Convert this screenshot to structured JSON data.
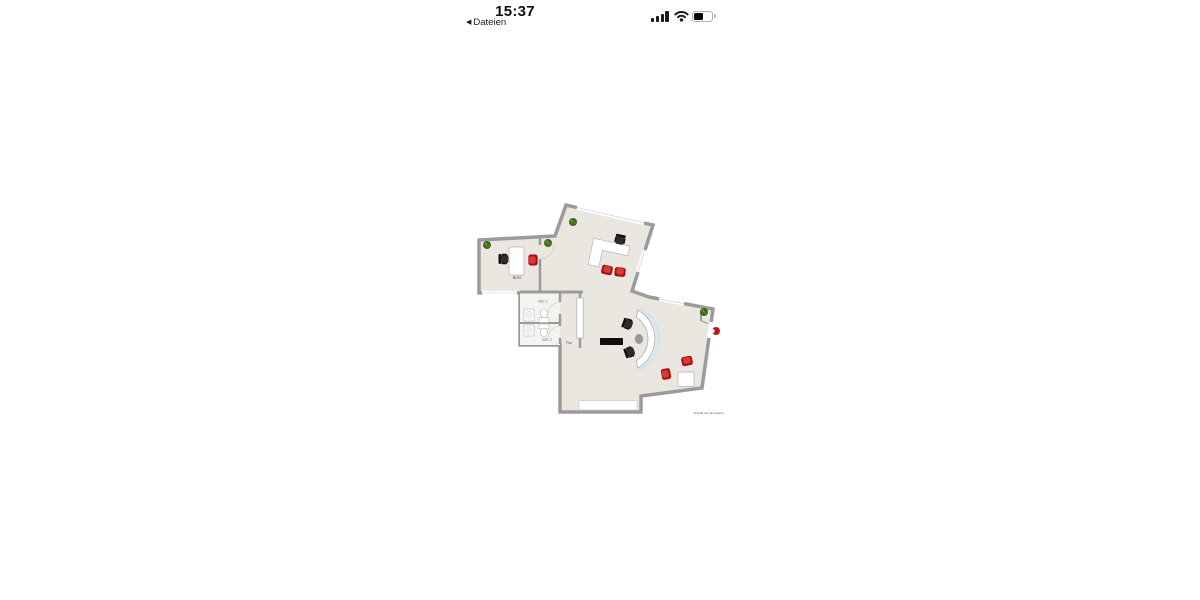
{
  "status_bar": {
    "time": "15:37",
    "back": {
      "icon": "◀",
      "label": "Dateien"
    },
    "battery_level_percent": 55
  },
  "floorplan": {
    "rooms": {
      "office_label": "Büro",
      "wc1_label": "WC 1",
      "wc2_label": "WC 2",
      "hallway_label": "Flur"
    },
    "watermark": "Erstellt mit raumplaner",
    "colors": {
      "floor": "#eae6e0",
      "wc_floor": "#f4f3ef",
      "wall": "#9b9b9b",
      "window": "#ffffff",
      "desk": "#ffffff",
      "chair_black": "#2c2c2c",
      "chair_red": "#c01215",
      "plant_green": "#3f601e",
      "counter_glass": "#cfe7f3",
      "sideboard_black": "#0e0e0e"
    }
  }
}
